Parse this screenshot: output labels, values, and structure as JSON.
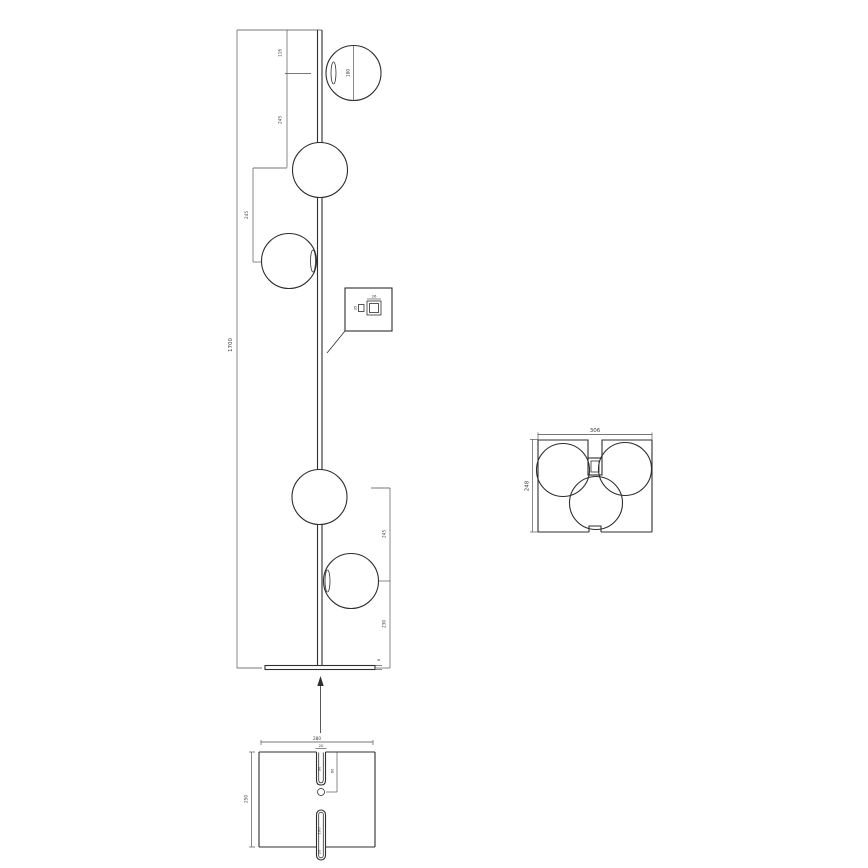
{
  "page": {
    "background": "#ffffff"
  },
  "drawing": {
    "kind": "technical dimension drawing",
    "subject": "floor lamp with five spherical glass shades, top view and base plate detail",
    "line_color": "#2f2f2f",
    "dim_color": "#4a4a4a",
    "front_view": {
      "overall_height": "1700",
      "top_to_globe1": "116",
      "globe1_to_globe2": "245",
      "globe_diameter": "180",
      "globe2_to_globe3": "245",
      "globe4_to_globe5": "245",
      "globe5_to_base": "230",
      "base_thickness": "8"
    },
    "switch_detail": {
      "switch_width": "26",
      "switch_height": "35"
    },
    "top_view": {
      "overall_width": "306",
      "overall_depth": "248"
    },
    "base_detail": {
      "base_width": "280",
      "slot_width": "20",
      "slot_length": "90",
      "hole_offset": "80",
      "base_depth": "250",
      "bottom_slot_length": "100",
      "bottom_slot_width": "20"
    }
  }
}
